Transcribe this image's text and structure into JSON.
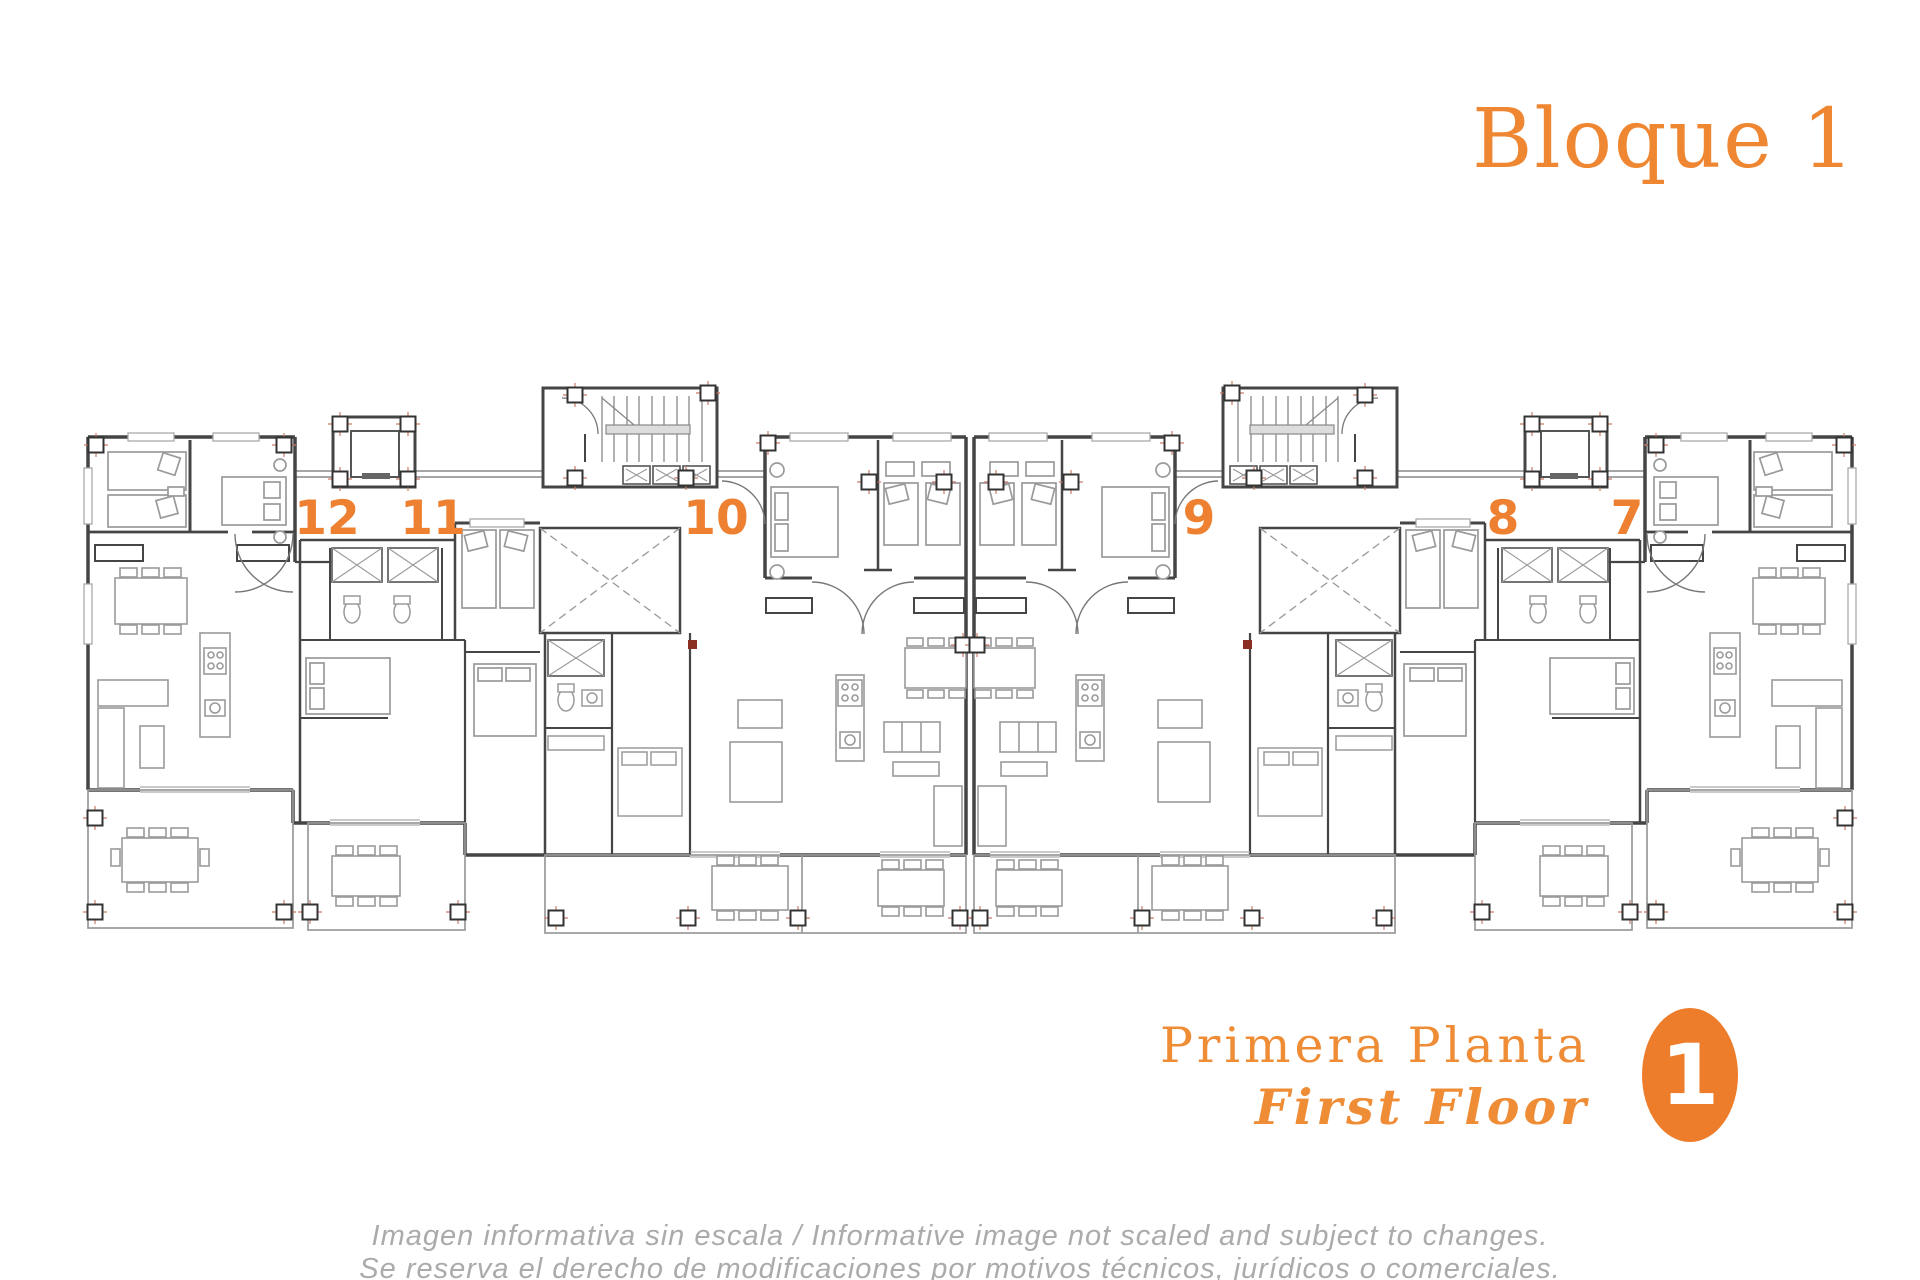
{
  "header": {
    "title": "Bloque 1",
    "title_color": "#ee8632"
  },
  "plan": {
    "units": [
      {
        "number": "12"
      },
      {
        "number": "11"
      },
      {
        "number": "10"
      },
      {
        "number": "9"
      },
      {
        "number": "8"
      },
      {
        "number": "7"
      }
    ],
    "unit_number_color": "#ee8032",
    "wall_color": "#454545",
    "furniture_color": "#9a9a9a",
    "column_marker_cross_color": "#cc7a66"
  },
  "footer": {
    "floor_label_es": "Primera Planta",
    "floor_label_en": "First Floor",
    "label_color": "#ef8c36",
    "badge": {
      "number": "1",
      "background": "#ee7d2b",
      "text_color": "#ffffff"
    }
  },
  "disclaimer": {
    "line1": "Imagen informativa sin escala /  Informative image not scaled and subject to changes.",
    "line2": "Se reserva el derecho de modificaciones por motivos técnicos, jurídicos o comerciales.",
    "color": "#ababab"
  }
}
